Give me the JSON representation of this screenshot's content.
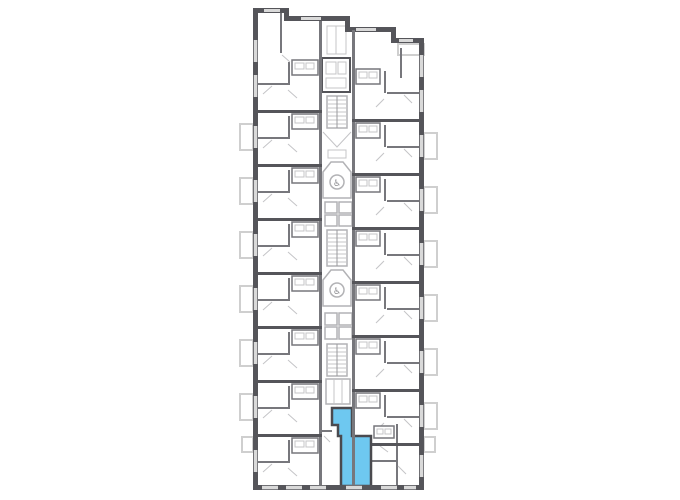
{
  "plan": {
    "kind": "residential-tower-floor-plan",
    "highlighted_unit": {
      "rooms": [
        "entrance-hall",
        "main-room"
      ],
      "location": "bottom-center"
    }
  },
  "colors": {
    "background": "#ffffff",
    "wall_dark": "#55555a",
    "wall_medium": "#77777c",
    "line_light": "#b2b2b5",
    "window_light": "#d9d9d9",
    "highlight": "#6EC8F0",
    "highlight_stroke": "#4a4a4f"
  },
  "icons": {
    "accessible_glyph": "♿"
  }
}
